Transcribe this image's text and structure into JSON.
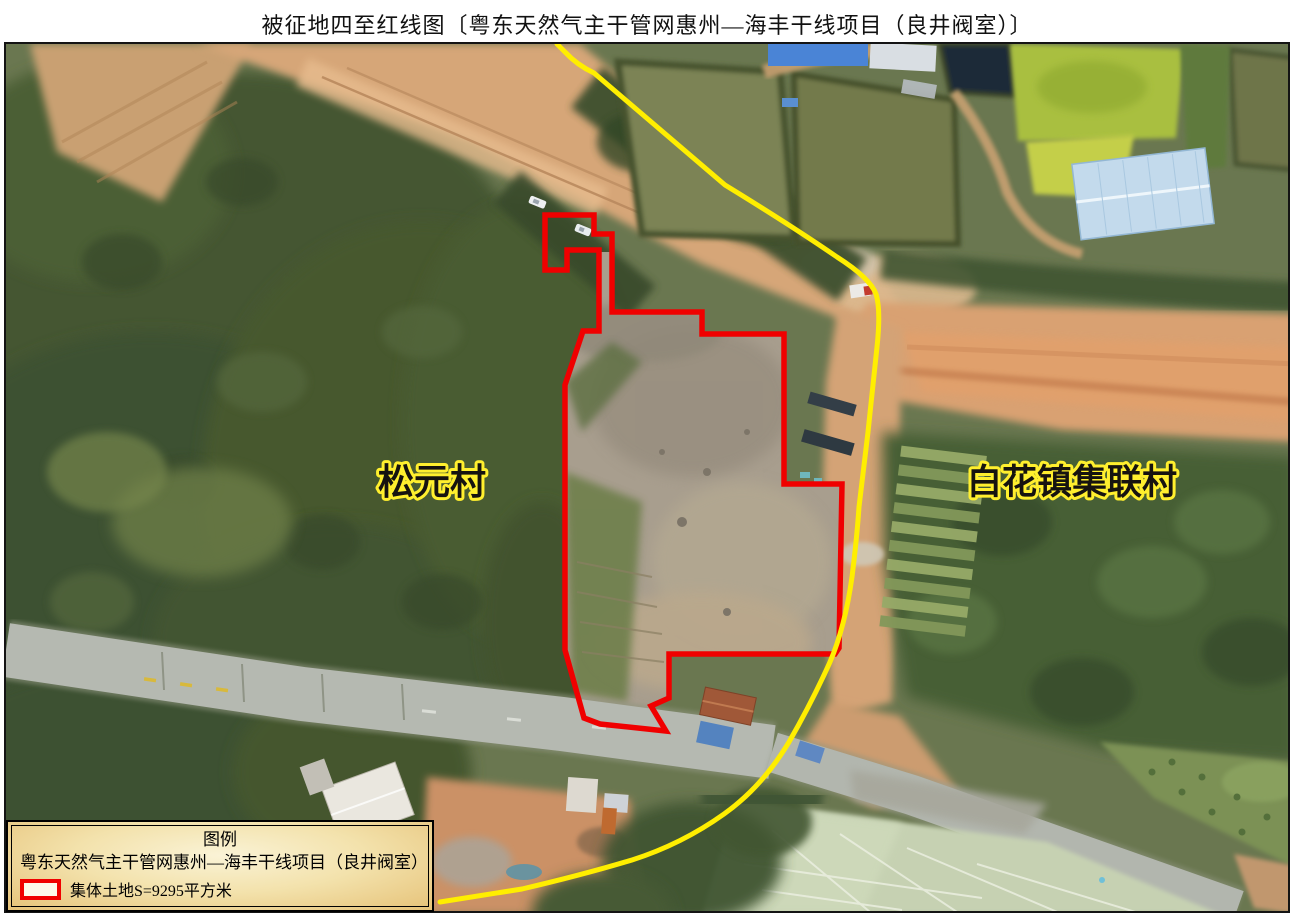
{
  "title": "被征地四至红线图〔粤东天然气主干管网惠州—海丰干线项目（良井阀室）〕",
  "map": {
    "village_left": "松元村",
    "village_right": "白花镇集联村",
    "colors": {
      "red_line": "#f00000",
      "boundary_line": "#ffee00",
      "label_outline": "#ffef2e"
    }
  },
  "legend": {
    "title": "图例",
    "project": "粤东天然气主干管网惠州—海丰干线项目（良井阀室）",
    "area_label": "集体土地S=9295平方米"
  }
}
